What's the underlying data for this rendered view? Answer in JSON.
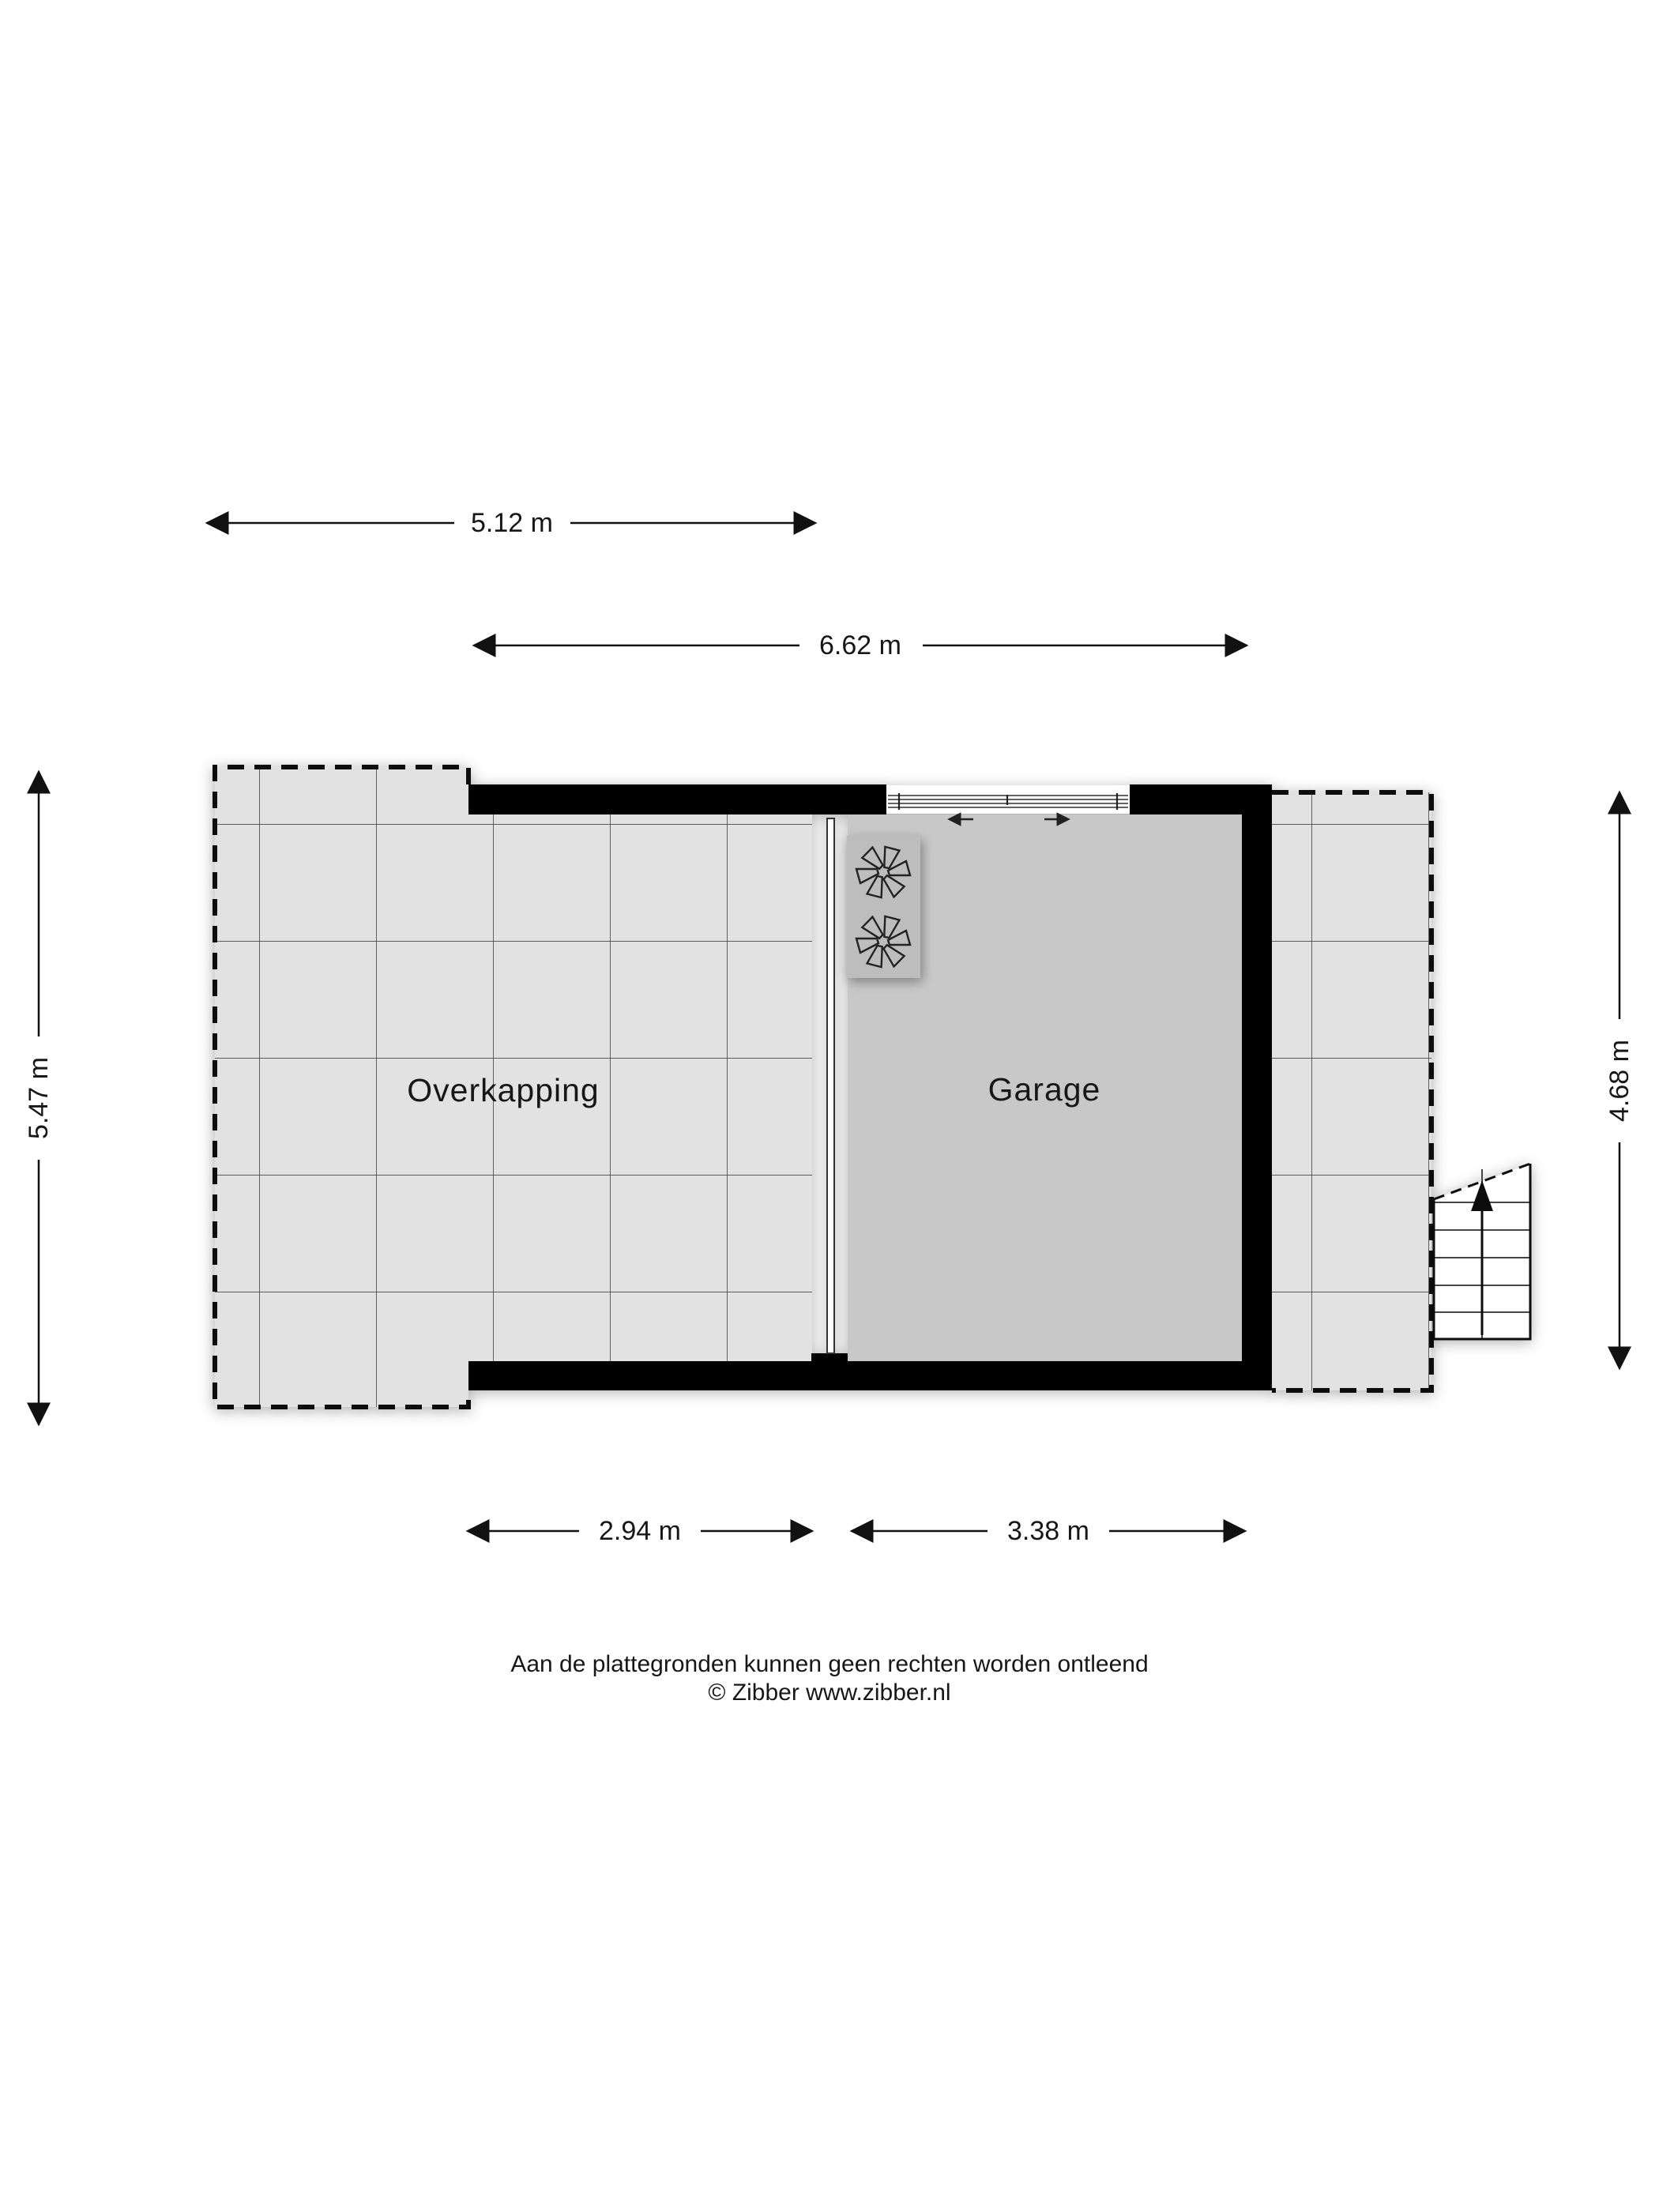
{
  "plan": {
    "type": "floor-plan",
    "rooms": {
      "overkapping": {
        "label": "Overkapping",
        "floor_color": "#e2e2e2"
      },
      "garage": {
        "label": "Garage",
        "floor_color": "#c8c8c8"
      }
    },
    "dimensions": {
      "top_overkapping": {
        "label": "5.12 m"
      },
      "top_total": {
        "label": "6.62 m"
      },
      "left_overkapping": {
        "label": "5.47 m"
      },
      "right_garage": {
        "label": "4.68 m"
      },
      "bottom_overkapping": {
        "label": "2.94 m"
      },
      "bottom_garage": {
        "label": "3.38 m"
      }
    },
    "icons": {
      "fan_unit": {
        "name": "fan-icon",
        "count": 2
      },
      "stairs": {
        "name": "stairs-up-arrow-icon",
        "direction": "up"
      },
      "garage_door": {
        "name": "sliding-door-icon",
        "arrows": [
          "left",
          "right"
        ]
      }
    },
    "colors": {
      "wall": "#050505",
      "overkapping_floor": "#e2e2e2",
      "garage_floor": "#c8c8c8",
      "fan_unit_box": "#bdbdbd",
      "tile_grid_line": "#4a4a4a",
      "text": "#171717"
    }
  },
  "footer": {
    "disclaimer": "Aan de plattegronden kunnen geen rechten worden ontleend",
    "copyright": "© Zibber www.zibber.nl"
  }
}
